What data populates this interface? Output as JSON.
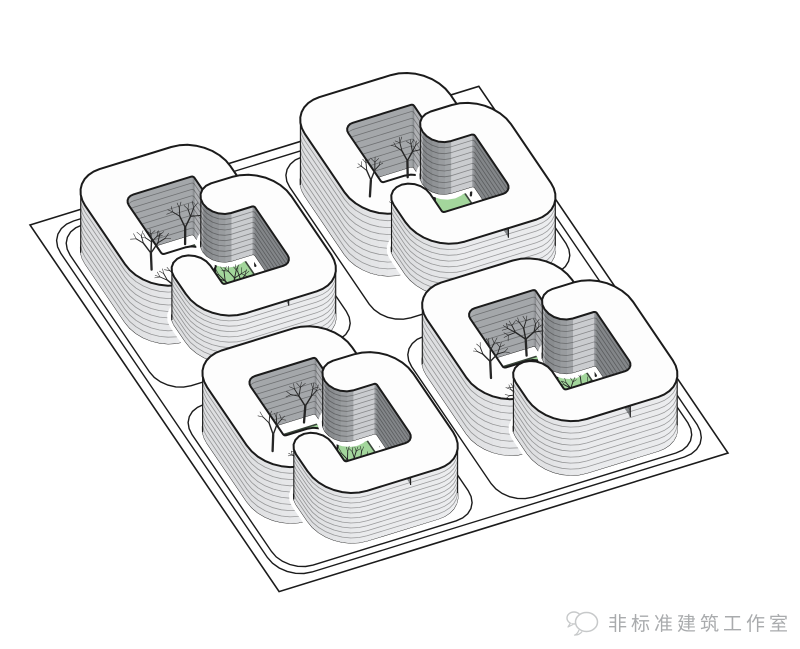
{
  "watermark": {
    "studio_name": "非标准建筑工作室",
    "logo": "speech-bubbles-logo"
  },
  "scene": {
    "type": "axonometric-architecture-diagram",
    "subject": "four-courtyard-blocks-with-interlocking-rounded-buildings",
    "colors": {
      "bg": "#ffffff",
      "line": "#1b1b1b",
      "roof": "#fdfdfd",
      "wall_inner_dark": "#8a8d90",
      "wall_outer_light": "#e2e3e5",
      "wall_cap": "#bcbec1",
      "stripe_dark": "rgba(25,25,25,0.38)",
      "courtyard_green": "#a3d69c",
      "courtyard_edge": "#3a463a",
      "tree": "#262626",
      "watermark_gray": "#a9abad",
      "logo_gray": "#c7c9ca"
    },
    "projection": {
      "origin": [
        30,
        225
      ],
      "axis_u": [
        0.955,
        -0.295
      ],
      "axis_v": [
        0.53,
        0.78
      ]
    },
    "plate": {
      "size": 470
    },
    "ring_road": {
      "inset": 10,
      "corner_radius": 30
    },
    "block": {
      "size": 190,
      "origins": [
        [
          25,
          25
        ],
        [
          255,
          25
        ],
        [
          25,
          255
        ],
        [
          255,
          255
        ]
      ],
      "street_inset": 8,
      "street_corner_radius": 28
    },
    "courtyard": {
      "inset": 50,
      "size": 90,
      "corner_radius": 18
    },
    "building": {
      "width": 38,
      "corner_radius": 34,
      "inner_radius": 10,
      "cap_radius": 19,
      "hook_bend_radius": 40,
      "hook_center": 130,
      "hook_reach": 62
    },
    "blocks": [
      {
        "name": "block-top-left",
        "heights": [
          58,
          48
        ],
        "floors": [
          9,
          9
        ],
        "trees": [
          [
            54,
            62
          ],
          [
            98,
            46
          ],
          [
            146,
            92
          ],
          [
            56,
            106
          ],
          [
            102,
            128
          ]
        ]
      },
      {
        "name": "block-top-right",
        "heights": [
          62,
          52
        ],
        "floors": [
          9,
          9
        ],
        "trees": [
          [
            56,
            56
          ],
          [
            100,
            48
          ],
          [
            144,
            88
          ],
          [
            60,
            110
          ]
        ]
      },
      {
        "name": "block-bottom-left",
        "heights": [
          56,
          50
        ],
        "floors": [
          9,
          10
        ],
        "trees": [
          [
            52,
            64
          ],
          [
            96,
            44
          ],
          [
            148,
            94
          ],
          [
            58,
            108
          ],
          [
            104,
            126
          ]
        ]
      },
      {
        "name": "block-bottom-right",
        "heights": [
          56,
          54
        ],
        "floors": [
          8,
          9
        ],
        "trees": [
          [
            54,
            58
          ],
          [
            98,
            46
          ],
          [
            146,
            90
          ],
          [
            62,
            112
          ],
          [
            108,
            124
          ]
        ]
      }
    ],
    "tree_scale": 1.1
  }
}
